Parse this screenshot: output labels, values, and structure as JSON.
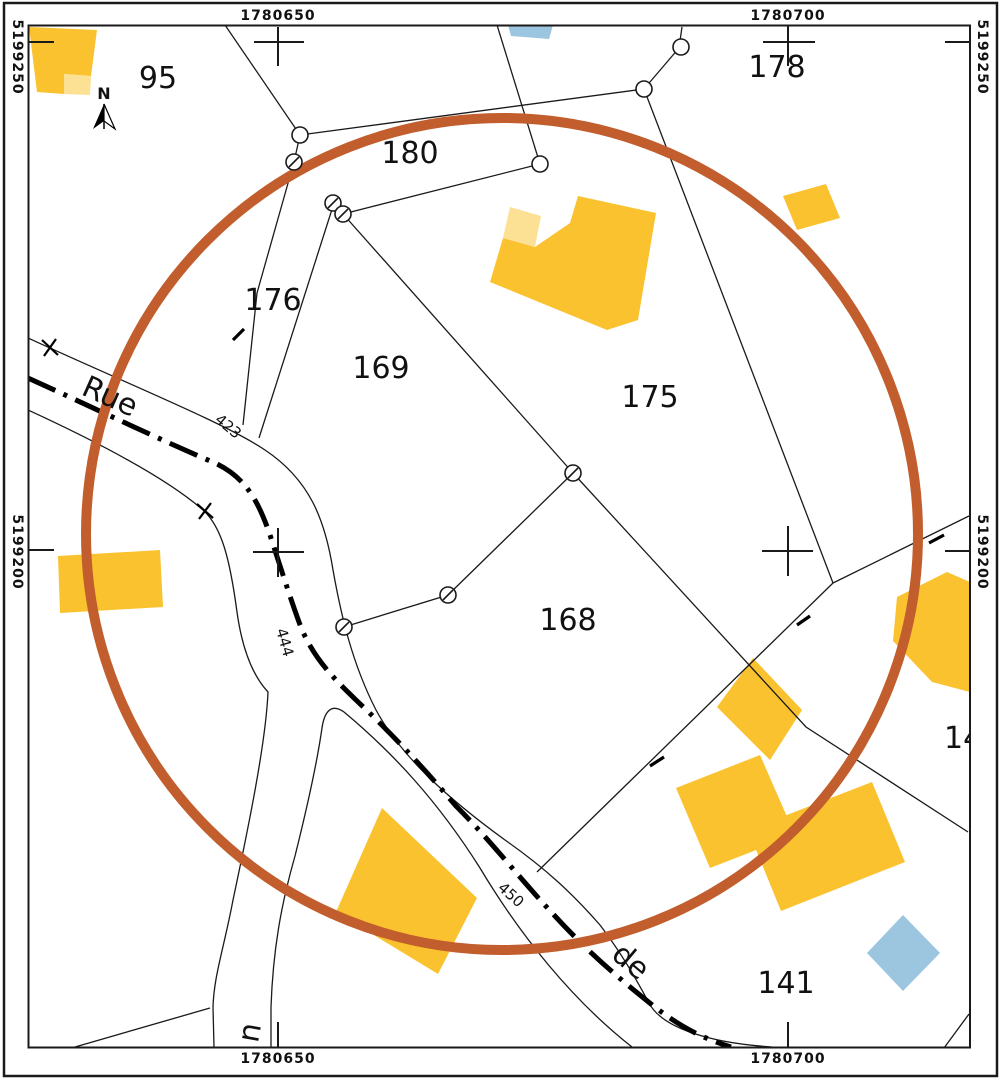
{
  "map": {
    "kind": "cadastral-map",
    "frame": {
      "top": [
        "1780650",
        "1780700"
      ],
      "bottom": [
        "1780650",
        "1780700"
      ],
      "left": [
        "5199250",
        "5199200"
      ],
      "right": [
        "5199250",
        "5199200"
      ]
    },
    "parcels": [
      {
        "label": "95"
      },
      {
        "label": "178"
      },
      {
        "label": "180"
      },
      {
        "label": "176"
      },
      {
        "label": "169"
      },
      {
        "label": "175"
      },
      {
        "label": "168"
      },
      {
        "label": "141"
      },
      {
        "label": "14"
      }
    ],
    "streets": {
      "word_rue": "Rue",
      "word_de": "de",
      "word_branch": "u"
    },
    "road_numbers": {
      "n423": "423",
      "n444": "444",
      "n450": "450"
    },
    "north_label": "N",
    "colors": {
      "building_yellow": "#FAC22F",
      "building_yellow_light": "#FCE094",
      "building_blue": "#9CC6DF",
      "highlight_orange": "#C25E2D",
      "line_black": "#1A1A1A"
    }
  }
}
